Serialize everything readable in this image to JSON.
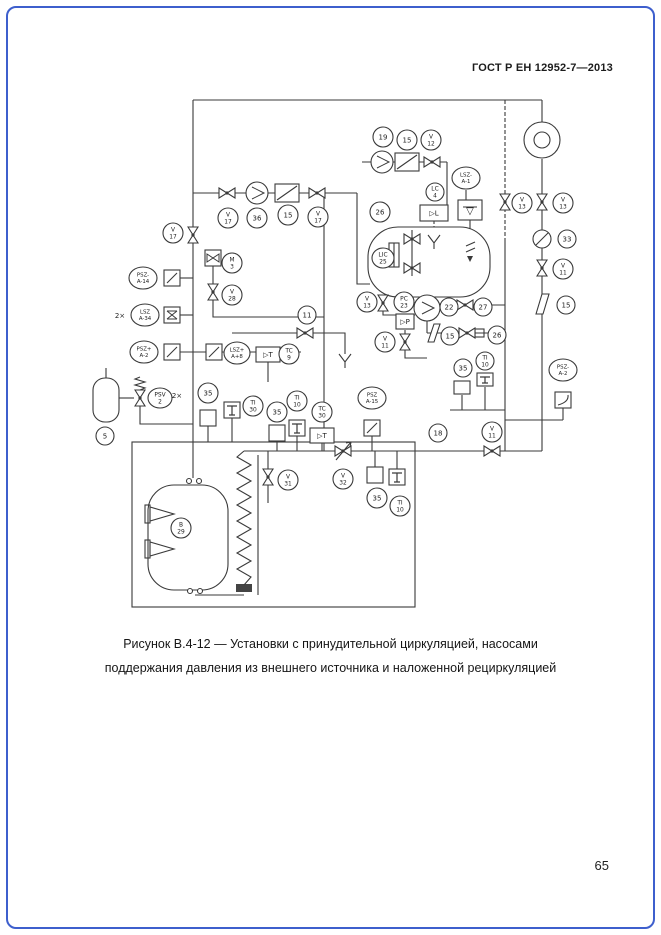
{
  "page": {
    "header": "ГОСТ Р ЕН 12952-7—2013",
    "caption_line1": "Рисунок В.4-12 — Установки с принудительной циркуляцией, насосами",
    "caption_line2": "поддержания давления из внешнего источника и наложенной рециркуляцией",
    "page_number": "65"
  },
  "colors": {
    "border": "#3e5fcd",
    "line": "#3a3a3a"
  },
  "diagram": {
    "bubbles": [
      {
        "x": 173,
        "y": 233,
        "rx": 10,
        "lines": [
          "V",
          "17"
        ]
      },
      {
        "x": 228,
        "y": 218,
        "rx": 10,
        "lines": [
          "V",
          "17"
        ]
      },
      {
        "x": 257,
        "y": 218,
        "rx": 10,
        "lines": [
          "36"
        ]
      },
      {
        "x": 288,
        "y": 215,
        "rx": 10,
        "lines": [
          "15"
        ]
      },
      {
        "x": 318,
        "y": 217,
        "rx": 10,
        "lines": [
          "V",
          "17"
        ]
      },
      {
        "x": 232,
        "y": 263,
        "rx": 10,
        "lines": [
          "M",
          "3"
        ]
      },
      {
        "x": 232,
        "y": 295,
        "rx": 10,
        "lines": [
          "V",
          "28"
        ]
      },
      {
        "x": 143,
        "y": 278,
        "rx": 14,
        "ry": 11,
        "lines": [
          "PSZ-",
          "A-14"
        ]
      },
      {
        "x": 145,
        "y": 315,
        "rx": 14,
        "ry": 11,
        "lines": [
          "LSZ",
          "A-34"
        ]
      },
      {
        "x": 144,
        "y": 352,
        "rx": 14,
        "ry": 11,
        "lines": [
          "PSZ+",
          "A-2"
        ]
      },
      {
        "x": 237,
        "y": 353,
        "rx": 13,
        "ry": 11,
        "lines": [
          "LSZ+",
          "A+8"
        ]
      },
      {
        "x": 289,
        "y": 354,
        "rx": 10,
        "lines": [
          "TC",
          "9"
        ]
      },
      {
        "x": 307,
        "y": 315,
        "rx": 9,
        "lines": [
          "11"
        ]
      },
      {
        "x": 160,
        "y": 398,
        "rx": 12,
        "ry": 10,
        "lines": [
          "PSV",
          "2"
        ]
      },
      {
        "x": 105,
        "y": 436,
        "rx": 9,
        "lines": [
          "5"
        ]
      },
      {
        "x": 208,
        "y": 393,
        "rx": 10,
        "lines": [
          "35"
        ]
      },
      {
        "x": 253,
        "y": 406,
        "rx": 10,
        "lines": [
          "TI",
          "30"
        ]
      },
      {
        "x": 277,
        "y": 412,
        "rx": 10,
        "lines": [
          "35"
        ]
      },
      {
        "x": 297,
        "y": 401,
        "rx": 10,
        "lines": [
          "TI",
          "10"
        ]
      },
      {
        "x": 322,
        "y": 412,
        "rx": 10,
        "lines": [
          "TC",
          "30"
        ]
      },
      {
        "x": 343,
        "y": 479,
        "rx": 10,
        "lines": [
          "V",
          "32"
        ]
      },
      {
        "x": 377,
        "y": 498,
        "rx": 10,
        "lines": [
          "35"
        ]
      },
      {
        "x": 400,
        "y": 506,
        "rx": 10,
        "lines": [
          "TI",
          "10"
        ]
      },
      {
        "x": 383,
        "y": 137,
        "rx": 10,
        "lines": [
          "19"
        ]
      },
      {
        "x": 407,
        "y": 140,
        "rx": 10,
        "lines": [
          "15"
        ]
      },
      {
        "x": 431,
        "y": 140,
        "rx": 10,
        "lines": [
          "V",
          "12"
        ]
      },
      {
        "x": 466,
        "y": 178,
        "rx": 14,
        "ry": 11,
        "lines": [
          "LSZ-",
          "A-1"
        ]
      },
      {
        "x": 435,
        "y": 192,
        "rx": 9,
        "lines": [
          "LC",
          "4"
        ]
      },
      {
        "x": 380,
        "y": 212,
        "rx": 10,
        "lines": [
          "26"
        ]
      },
      {
        "x": 383,
        "y": 258,
        "rx": 11,
        "lines": [
          "LIC",
          "25"
        ]
      },
      {
        "x": 367,
        "y": 302,
        "rx": 10,
        "lines": [
          "V",
          "13"
        ]
      },
      {
        "x": 404,
        "y": 302,
        "rx": 10,
        "lines": [
          "PC",
          "23"
        ]
      },
      {
        "x": 449,
        "y": 307,
        "rx": 9,
        "lines": [
          "22"
        ]
      },
      {
        "x": 483,
        "y": 307,
        "rx": 9,
        "lines": [
          "27"
        ]
      },
      {
        "x": 385,
        "y": 342,
        "rx": 10,
        "lines": [
          "V",
          "11"
        ]
      },
      {
        "x": 450,
        "y": 336,
        "rx": 9,
        "lines": [
          "15"
        ]
      },
      {
        "x": 497,
        "y": 335,
        "rx": 9,
        "lines": [
          "26"
        ]
      },
      {
        "x": 485,
        "y": 361,
        "rx": 9,
        "lines": [
          "TI",
          "10"
        ]
      },
      {
        "x": 463,
        "y": 368,
        "rx": 9,
        "lines": [
          "35"
        ]
      },
      {
        "x": 438,
        "y": 433,
        "rx": 9,
        "lines": [
          "18"
        ]
      },
      {
        "x": 492,
        "y": 432,
        "rx": 10,
        "lines": [
          "V",
          "11"
        ]
      },
      {
        "x": 522,
        "y": 203,
        "rx": 10,
        "lines": [
          "V",
          "13"
        ]
      },
      {
        "x": 563,
        "y": 203,
        "rx": 10,
        "lines": [
          "V",
          "13"
        ]
      },
      {
        "x": 567,
        "y": 239,
        "rx": 9,
        "lines": [
          "33"
        ]
      },
      {
        "x": 563,
        "y": 269,
        "rx": 10,
        "lines": [
          "V",
          "11"
        ]
      },
      {
        "x": 566,
        "y": 305,
        "rx": 9,
        "lines": [
          "15"
        ]
      },
      {
        "x": 563,
        "y": 370,
        "rx": 14,
        "ry": 11,
        "lines": [
          "PSZ-",
          "A-2"
        ]
      },
      {
        "x": 372,
        "y": 398,
        "rx": 14,
        "ry": 11,
        "lines": [
          "PSZ",
          "A-15"
        ]
      },
      {
        "x": 288,
        "y": 480,
        "rx": 10,
        "lines": [
          "V",
          "31"
        ]
      },
      {
        "x": 181,
        "y": 528,
        "rx": 10,
        "lines": [
          "B",
          "29"
        ]
      }
    ],
    "boxes": [
      {
        "x": 164,
        "y": 270,
        "w": 16,
        "h": 16,
        "sym": "diag"
      },
      {
        "x": 164,
        "y": 307,
        "w": 16,
        "h": 16,
        "sym": "hourglass"
      },
      {
        "x": 164,
        "y": 344,
        "w": 16,
        "h": 16,
        "sym": "diag"
      },
      {
        "x": 206,
        "y": 344,
        "w": 16,
        "h": 16,
        "sym": "diag"
      },
      {
        "x": 205,
        "y": 250,
        "w": 16,
        "h": 16,
        "sym": "valve"
      },
      {
        "x": 364,
        "y": 420,
        "w": 16,
        "h": 16,
        "sym": "diag"
      },
      {
        "x": 555,
        "y": 392,
        "w": 16,
        "h": 16,
        "sym": "curve"
      },
      {
        "x": 200,
        "y": 410,
        "w": 16,
        "h": 16
      },
      {
        "x": 269,
        "y": 425,
        "w": 16,
        "h": 16
      },
      {
        "x": 367,
        "y": 467,
        "w": 16,
        "h": 16
      },
      {
        "x": 454,
        "y": 381,
        "w": 16,
        "h": 13
      },
      {
        "x": 224,
        "y": 402,
        "w": 16,
        "h": 16,
        "sym": "tee"
      },
      {
        "x": 289,
        "y": 420,
        "w": 16,
        "h": 16,
        "sym": "tee"
      },
      {
        "x": 389,
        "y": 469,
        "w": 16,
        "h": 16,
        "sym": "tee"
      },
      {
        "x": 477,
        "y": 373,
        "w": 16,
        "h": 13,
        "sym": "tee"
      },
      {
        "x": 420,
        "y": 205,
        "w": 28,
        "h": 16,
        "text": "▷L"
      },
      {
        "x": 458,
        "y": 200,
        "w": 24,
        "h": 20,
        "sym": "level"
      },
      {
        "x": 396,
        "y": 314,
        "w": 18,
        "h": 15,
        "text": "▷P"
      },
      {
        "x": 256,
        "y": 347,
        "w": 24,
        "h": 15,
        "text": "▷T"
      },
      {
        "x": 310,
        "y": 428,
        "w": 24,
        "h": 15,
        "text": "▷T"
      }
    ],
    "texts": [
      {
        "x": 120,
        "y": 318,
        "t": "2×"
      },
      {
        "x": 177,
        "y": 398,
        "t": "2×"
      }
    ]
  }
}
